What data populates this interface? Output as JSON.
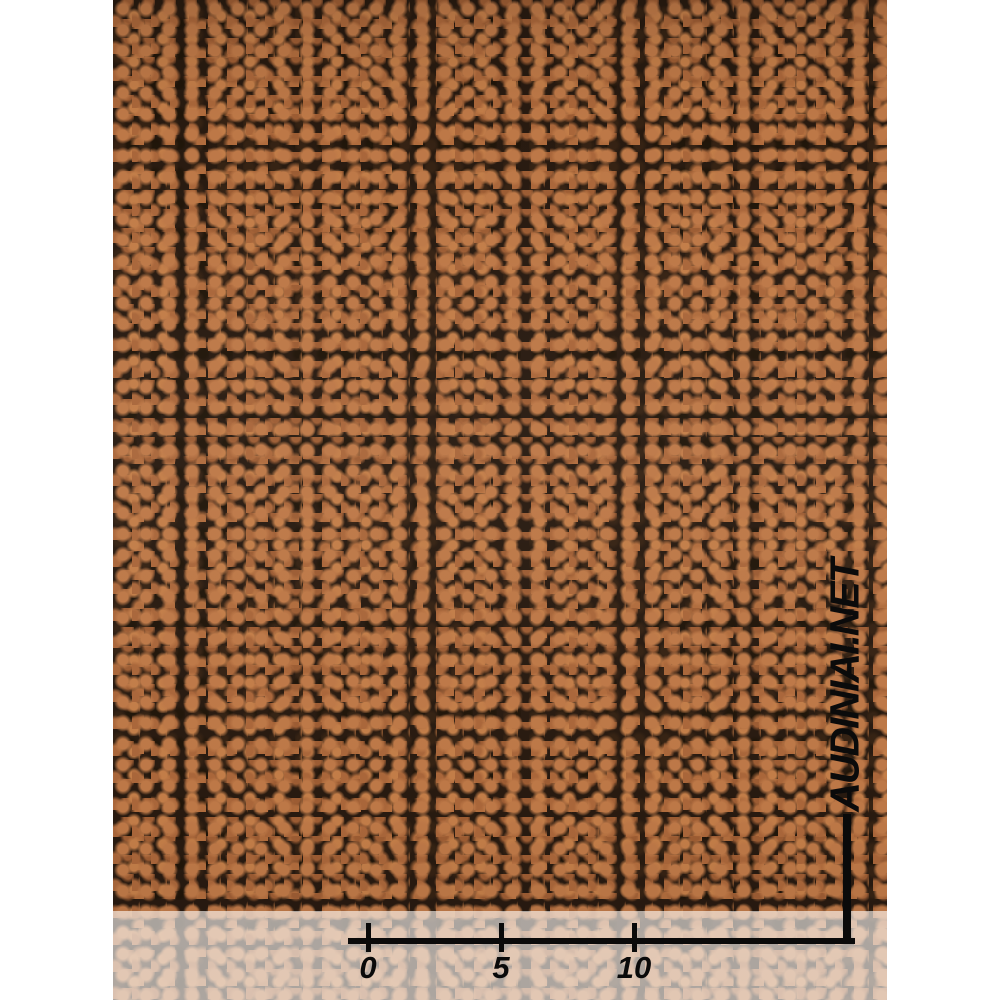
{
  "photo": {
    "subject": "copper-brown speckled knit fabric swatch"
  },
  "watermark": {
    "text": "AUDINIAI.NET"
  },
  "ruler": {
    "tick_labels": [
      "0",
      "5",
      "10"
    ]
  },
  "colors": {
    "fabric_copper": "#b5713f",
    "fabric_copper_light": "#c27d48",
    "fabric_dark": "#281a10",
    "ruler_black": "#0a0a0a",
    "strip_overlay": "rgba(255,251,248,0.62)",
    "page_background": "#ffffff"
  }
}
